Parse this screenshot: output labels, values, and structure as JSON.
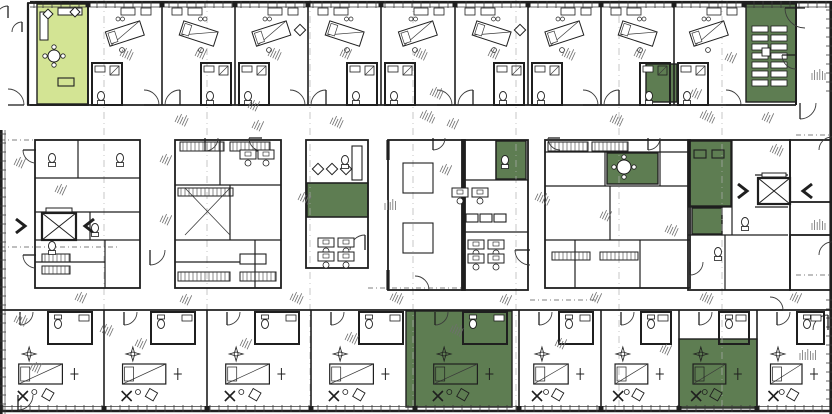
{
  "canvas": {
    "w": 832,
    "h": 414
  },
  "colors": {
    "paper": "#ffffff",
    "wall": "#1f1f1f",
    "thin": "#3a3a3a",
    "highlight_green": "#5e7d52",
    "highlight_light_green": "#d3e494",
    "grid": "#b0b0b0",
    "noise": "#6f6f6f"
  },
  "modules": {
    "top_rooms": {
      "walls": [
        88,
        162,
        235,
        308,
        381,
        455,
        528,
        601,
        674,
        744
      ],
      "y0": 3,
      "y1": 105
    },
    "bottom_rooms": {
      "walls": [
        0,
        104,
        207,
        311,
        415,
        519,
        601,
        679,
        757,
        832
      ],
      "y0": 310,
      "y1": 409
    }
  },
  "highlighted_rooms": [
    {
      "name": "lounge-top-left",
      "x": 37,
      "y": 4,
      "w": 51,
      "h": 100,
      "tone": "light"
    },
    {
      "name": "pod-top-right",
      "x": 646,
      "y": 64,
      "w": 31,
      "h": 38,
      "tone": "dark"
    },
    {
      "name": "meeting-room-top-right",
      "x": 746,
      "y": 4,
      "w": 50,
      "h": 98,
      "tone": "dark"
    },
    {
      "name": "mid-left-room",
      "x": 307,
      "y": 183,
      "w": 61,
      "h": 34,
      "tone": "dark"
    },
    {
      "name": "mid-center-room",
      "x": 496,
      "y": 141,
      "w": 30,
      "h": 38,
      "tone": "dark"
    },
    {
      "name": "mid-right-room",
      "x": 607,
      "y": 153,
      "w": 51,
      "h": 31,
      "tone": "dark"
    },
    {
      "name": "far-right-room",
      "x": 689,
      "y": 141,
      "w": 42,
      "h": 65,
      "tone": "dark"
    },
    {
      "name": "far-right-pod",
      "x": 692,
      "y": 208,
      "w": 30,
      "h": 26,
      "tone": "dark"
    },
    {
      "name": "bottom-middle-room",
      "x": 406,
      "y": 311,
      "w": 106,
      "h": 96,
      "tone": "dark"
    },
    {
      "name": "bottom-right-room",
      "x": 679,
      "y": 339,
      "w": 78,
      "h": 69,
      "tone": "dark"
    }
  ],
  "blocks": [
    {
      "x": 35,
      "y": 140,
      "w": 105,
      "h": 148
    },
    {
      "x": 175,
      "y": 140,
      "w": 106,
      "h": 148
    },
    {
      "x": 306,
      "y": 140,
      "w": 62,
      "h": 128
    },
    {
      "x": 388,
      "y": 140,
      "w": 77,
      "h": 150
    },
    {
      "x": 462,
      "y": 140,
      "w": 66,
      "h": 150
    },
    {
      "x": 545,
      "y": 140,
      "w": 145,
      "h": 148
    },
    {
      "x": 688,
      "y": 140,
      "w": 102,
      "h": 150
    },
    {
      "x": 790,
      "y": 140,
      "w": 42,
      "h": 62
    },
    {
      "x": 790,
      "y": 235,
      "w": 42,
      "h": 55
    }
  ],
  "partitions": [
    [
      35,
      178,
      140,
      178
    ],
    [
      78,
      140,
      78,
      178
    ],
    [
      35,
      212,
      140,
      212
    ],
    [
      35,
      240,
      140,
      240
    ],
    [
      90,
      212,
      90,
      240
    ],
    [
      35,
      262,
      105,
      262
    ],
    [
      105,
      240,
      105,
      288
    ],
    [
      175,
      185,
      281,
      185
    ],
    [
      220,
      140,
      220,
      185
    ],
    [
      175,
      240,
      281,
      240
    ],
    [
      230,
      185,
      230,
      240
    ],
    [
      175,
      262,
      240,
      262
    ],
    [
      255,
      240,
      255,
      288
    ],
    [
      306,
      183,
      368,
      183
    ],
    [
      306,
      217,
      368,
      217
    ],
    [
      462,
      180,
      528,
      180
    ],
    [
      496,
      140,
      496,
      180
    ],
    [
      462,
      232,
      528,
      232
    ],
    [
      545,
      152,
      690,
      152
    ],
    [
      545,
      186,
      690,
      186
    ],
    [
      605,
      152,
      605,
      186
    ],
    [
      660,
      140,
      660,
      186
    ],
    [
      545,
      240,
      690,
      240
    ],
    [
      610,
      186,
      610,
      240
    ],
    [
      575,
      240,
      575,
      288
    ],
    [
      640,
      240,
      640,
      288
    ],
    [
      688,
      207,
      732,
      207
    ],
    [
      688,
      235,
      788,
      235
    ],
    [
      732,
      140,
      732,
      235
    ],
    [
      755,
      175,
      788,
      175
    ],
    [
      755,
      207,
      788,
      207
    ],
    [
      725,
      235,
      725,
      290
    ]
  ],
  "thick_walls": [
    [
      463,
      140,
      463,
      290
    ],
    [
      388,
      140,
      388,
      160
    ],
    [
      388,
      270,
      388,
      290
    ]
  ],
  "elevators": [
    {
      "x": 42,
      "y": 213,
      "w": 34,
      "h": 27
    },
    {
      "x": 758,
      "y": 178,
      "w": 32,
      "h": 26
    }
  ],
  "stair_chevrons": [
    {
      "x": 20,
      "y": 226,
      "dir": "right"
    },
    {
      "x": 90,
      "y": 226,
      "dir": "left"
    },
    {
      "x": 742,
      "y": 191,
      "dir": "right"
    },
    {
      "x": 808,
      "y": 191,
      "dir": "left"
    }
  ],
  "grid_lines": {
    "vertical_x": [
      104,
      207,
      310,
      413,
      516,
      619,
      722
    ],
    "dash_segments": [
      [
        0,
        140,
        35,
        140
      ],
      [
        0,
        247,
        118,
        247
      ],
      [
        796,
        135,
        832,
        135
      ],
      [
        796,
        275,
        832,
        275
      ],
      [
        368,
        288,
        462,
        288
      ],
      [
        530,
        300,
        600,
        300
      ]
    ]
  },
  "arcs": [
    {
      "x": 8,
      "y": 105,
      "r": 16,
      "o": 3
    },
    {
      "x": 805,
      "y": 8,
      "r": 20,
      "o": 1
    },
    {
      "x": 800,
      "y": 103,
      "r": 16,
      "o": 0
    },
    {
      "x": 36,
      "y": 150,
      "r": 13,
      "o": 1
    },
    {
      "x": 36,
      "y": 255,
      "r": 13,
      "o": 1
    },
    {
      "x": 150,
      "y": 250,
      "r": 15,
      "o": 0
    },
    {
      "x": 365,
      "y": 250,
      "r": 15,
      "o": 2
    },
    {
      "x": 530,
      "y": 250,
      "r": 15,
      "o": 1
    },
    {
      "x": 690,
      "y": 262,
      "r": 13,
      "o": 0
    },
    {
      "x": 205,
      "y": 138,
      "r": 13,
      "o": 0
    },
    {
      "x": 262,
      "y": 138,
      "r": 13,
      "o": 1
    },
    {
      "x": 433,
      "y": 138,
      "r": 12,
      "o": 0
    },
    {
      "x": 560,
      "y": 138,
      "r": 12,
      "o": 1
    },
    {
      "x": 648,
      "y": 138,
      "r": 12,
      "o": 0
    },
    {
      "x": 770,
      "y": 310,
      "r": 13,
      "o": 3
    },
    {
      "x": 18,
      "y": 395,
      "r": 15,
      "o": 0
    },
    {
      "x": 828,
      "y": 330,
      "r": 15,
      "o": 2
    },
    {
      "x": 415,
      "y": 290,
      "r": 14,
      "o": 3
    },
    {
      "x": 8,
      "y": 18,
      "r": 12,
      "o": 2
    },
    {
      "x": 22,
      "y": 32,
      "r": 10,
      "o": 2
    },
    {
      "x": 796,
      "y": 55,
      "r": 14,
      "o": 1
    },
    {
      "x": 832,
      "y": 150,
      "r": 13,
      "o": 2
    },
    {
      "x": 832,
      "y": 255,
      "r": 13,
      "o": 2
    }
  ],
  "hatch_racks": [
    [
      180,
      142,
      44,
      9
    ],
    [
      230,
      142,
      40,
      9
    ],
    [
      178,
      188,
      55,
      8
    ],
    [
      548,
      142,
      40,
      9
    ],
    [
      592,
      142,
      36,
      9
    ],
    [
      552,
      252,
      38,
      8
    ],
    [
      600,
      252,
      38,
      8
    ],
    [
      42,
      254,
      28,
      8
    ],
    [
      42,
      266,
      28,
      8
    ],
    [
      178,
      272,
      52,
      9
    ],
    [
      240,
      272,
      36,
      9
    ]
  ],
  "tables": [
    [
      403,
      163,
      30,
      30
    ],
    [
      403,
      223,
      30,
      30
    ],
    [
      352,
      146,
      10,
      34
    ],
    [
      694,
      150,
      12,
      8
    ],
    [
      712,
      150,
      12,
      8
    ],
    [
      466,
      214,
      12,
      8
    ],
    [
      480,
      214,
      12,
      8
    ],
    [
      494,
      214,
      12,
      8
    ],
    [
      240,
      254,
      26,
      10
    ],
    [
      58,
      78,
      16,
      8
    ]
  ],
  "desks": [
    [
      452,
      188
    ],
    [
      472,
      188
    ],
    [
      468,
      240
    ],
    [
      488,
      240
    ],
    [
      468,
      254
    ],
    [
      488,
      254
    ],
    [
      318,
      238
    ],
    [
      338,
      238
    ],
    [
      318,
      252
    ],
    [
      338,
      252
    ],
    [
      240,
      150
    ],
    [
      258,
      150
    ]
  ],
  "diamond_chairs": [
    [
      318,
      169,
      8
    ],
    [
      332,
      169,
      8
    ],
    [
      346,
      169,
      8
    ],
    [
      48,
      14,
      7
    ],
    [
      75,
      12,
      7
    ],
    [
      300,
      30,
      8
    ],
    [
      520,
      30,
      8
    ]
  ],
  "round_tables": [
    {
      "x": 624,
      "y": 167,
      "r": 7
    },
    {
      "x": 54,
      "y": 56,
      "r": 6
    }
  ],
  "toilets": [
    [
      52,
      158
    ],
    [
      120,
      158
    ],
    [
      95,
      228
    ],
    [
      745,
      222
    ],
    [
      718,
      252
    ],
    [
      52,
      246
    ],
    [
      345,
      160
    ],
    [
      505,
      160
    ]
  ],
  "ladder_table": {
    "x": 752,
    "y": 26,
    "cols": 2,
    "rows": 7,
    "cw": 16,
    "ch": 6,
    "gap": 3,
    "cx": 766,
    "cy": 52
  },
  "cross_lines": [
    [
      185,
      188,
      230,
      235
    ],
    [
      230,
      188,
      185,
      235
    ]
  ],
  "noise_clusters": [
    [
      120,
      56,
      -65,
      5
    ],
    [
      195,
      56,
      -65,
      4
    ],
    [
      268,
      56,
      -65,
      5
    ],
    [
      340,
      56,
      -65,
      4
    ],
    [
      414,
      56,
      -65,
      5
    ],
    [
      488,
      56,
      -65,
      4
    ],
    [
      562,
      56,
      -65,
      5
    ],
    [
      634,
      56,
      -65,
      4
    ],
    [
      175,
      122,
      -65,
      5
    ],
    [
      252,
      128,
      -65,
      4
    ],
    [
      330,
      124,
      -65,
      5
    ],
    [
      420,
      118,
      -65,
      6
    ],
    [
      447,
      126,
      -65,
      4
    ],
    [
      610,
      122,
      -65,
      5
    ],
    [
      700,
      118,
      -65,
      6
    ],
    [
      762,
      120,
      -65,
      4
    ],
    [
      160,
      162,
      -65,
      4
    ],
    [
      160,
      222,
      -65,
      4
    ],
    [
      298,
      200,
      -65,
      5
    ],
    [
      385,
      210,
      -90,
      5
    ],
    [
      440,
      172,
      -65,
      4
    ],
    [
      535,
      200,
      -65,
      6
    ],
    [
      600,
      218,
      -65,
      4
    ],
    [
      665,
      232,
      -65,
      5
    ],
    [
      770,
      152,
      -65,
      5
    ],
    [
      812,
      80,
      -90,
      6
    ],
    [
      812,
      230,
      -90,
      6
    ],
    [
      55,
      192,
      -65,
      4
    ],
    [
      14,
      165,
      -65,
      4
    ],
    [
      14,
      322,
      -65,
      5
    ],
    [
      100,
      332,
      -65,
      5
    ],
    [
      75,
      300,
      -65,
      4
    ],
    [
      180,
      302,
      -65,
      4
    ],
    [
      290,
      300,
      -65,
      5
    ],
    [
      390,
      300,
      -65,
      5
    ],
    [
      500,
      302,
      -65,
      4
    ],
    [
      590,
      300,
      -65,
      4
    ],
    [
      700,
      300,
      -65,
      5
    ],
    [
      790,
      300,
      -65,
      4
    ],
    [
      30,
      370,
      -65,
      4
    ],
    [
      135,
      346,
      -65,
      4
    ],
    [
      240,
      346,
      -65,
      4
    ],
    [
      345,
      340,
      -65,
      5
    ],
    [
      450,
      332,
      -65,
      5
    ],
    [
      555,
      346,
      -65,
      4
    ],
    [
      660,
      352,
      -65,
      4
    ],
    [
      800,
      360,
      -90,
      7
    ],
    [
      430,
      95,
      -65,
      5
    ],
    [
      248,
      108,
      -65,
      4
    ],
    [
      690,
      96,
      -65,
      4
    ],
    [
      725,
      60,
      -65,
      4
    ]
  ]
}
